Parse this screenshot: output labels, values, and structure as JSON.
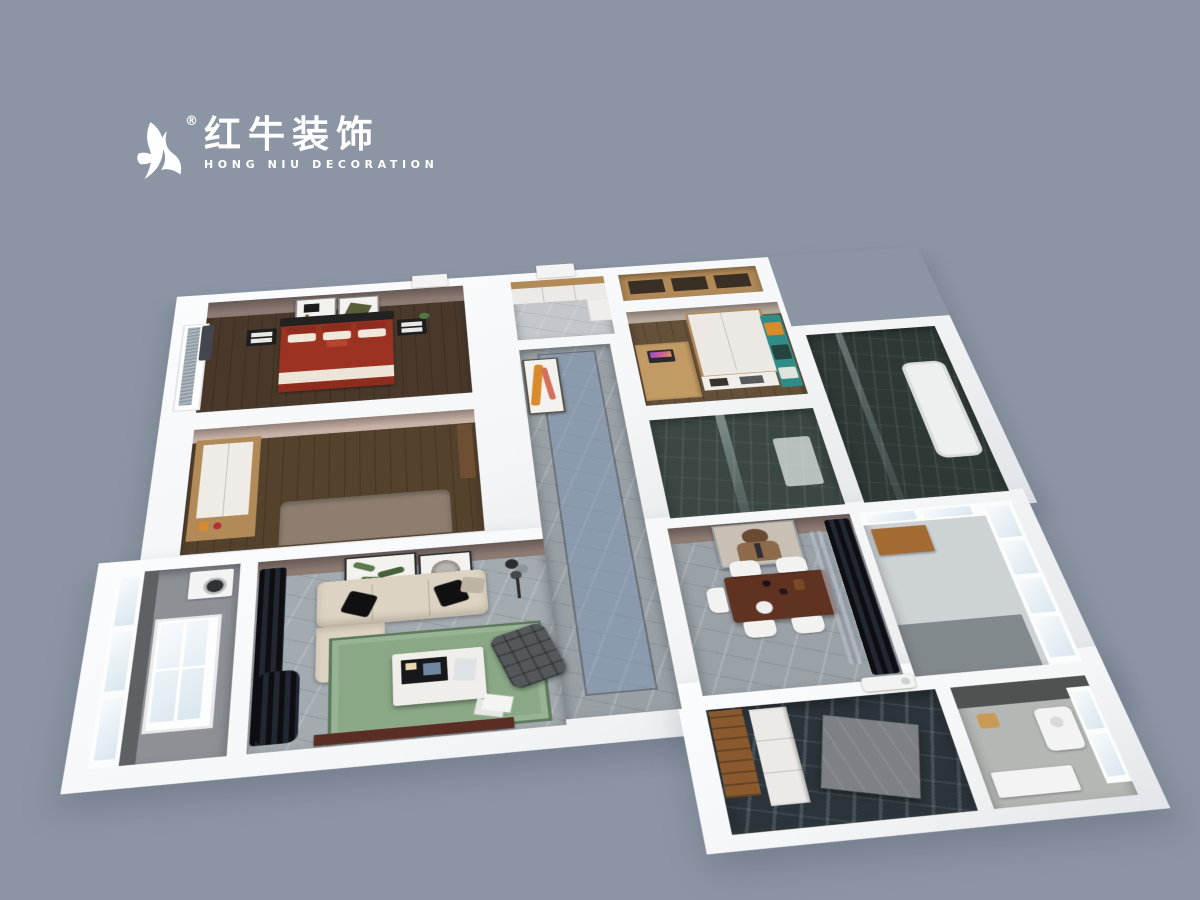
{
  "logo": {
    "brand_cn": "红牛装饰",
    "brand_en": "HONG NIU DECORATION",
    "registered_mark": "®",
    "icon": "bull-logo-icon",
    "color": "#ffffff"
  },
  "scene": {
    "type": "3d-floorplan-dollhouse-render",
    "description": "Bird's-eye 3D rendering of a furnished three-bedroom apartment with white cut walls on a slate blue-gray background",
    "rooms": [
      {
        "name": "master-bedroom",
        "floor": "dark wood",
        "items": [
          "double bed with red duvet",
          "black headboard",
          "two wall artworks",
          "black nightstands",
          "window with gray blinds"
        ]
      },
      {
        "name": "second-bedroom",
        "floor": "dark wood",
        "items": [
          "wood-framed white wardrobe",
          "bed",
          "shelf with amber bottles"
        ]
      },
      {
        "name": "entry-hall",
        "floor": "light marble",
        "items": [
          "white shoe cabinet with wood top",
          "open entry door"
        ]
      },
      {
        "name": "storage-closet",
        "items": [
          "wood shelving unit"
        ]
      },
      {
        "name": "study-bedroom",
        "floor": "wood",
        "items": [
          "desk with laptop",
          "white wardrobe with wood trim",
          "bed with teal and orange bedding"
        ]
      },
      {
        "name": "corridor",
        "floor": "gray marble",
        "items": [
          "blue highlighted walkway",
          "orange abstract wall art"
        ]
      },
      {
        "name": "shower-bathroom",
        "floor": "dark tile",
        "items": [
          "glass partition",
          "shower tray"
        ]
      },
      {
        "name": "tub-bathroom",
        "floor": "dark tile",
        "items": [
          "white bathtub"
        ]
      },
      {
        "name": "living-room",
        "floor": "gray marble",
        "items": [
          "beige L-shaped sofa",
          "black throw pillows",
          "green rug",
          "white marble coffee table",
          "floor lamp",
          "leaf artwork",
          "round artwork",
          "gray lounge chair",
          "black curtains",
          "TV console"
        ]
      },
      {
        "name": "dining-room",
        "floor": "gray marble",
        "items": [
          "dark wood dining table",
          "white chairs",
          "bear-in-suit painting",
          "black curtains"
        ]
      },
      {
        "name": "left-balcony",
        "items": [
          "floor-to-ceiling windows",
          "washing machine"
        ]
      },
      {
        "name": "right-balcony",
        "items": [
          "window grid",
          "wood cabinet"
        ]
      },
      {
        "name": "kitchen",
        "floor": "dark marble tile",
        "items": [
          "white cabinets",
          "wood door panel",
          "concrete counter",
          "AC unit"
        ]
      },
      {
        "name": "utility-balcony",
        "items": [
          "water heater",
          "window",
          "basket",
          "washbasin"
        ]
      }
    ]
  },
  "palette": {
    "bg": "#8b95a3",
    "wall": "#f5f6f7",
    "wallShade": "#e2e5e9",
    "wallFaceMauve": "#8d7a73",
    "wallFacePink": "#c8b1a6",
    "woodFloorDark": "#4a392b",
    "woodFloorMid": "#655039",
    "woodCab": "#b28a58",
    "marbleGray": "#a3aab0",
    "marbleLight": "#c3c7cb",
    "corridorMarble": "#98a0a6",
    "runnerBlue": "#7d93b8",
    "tileDark": "#3b4743",
    "tileDarker": "#2e3835",
    "kitchenTile": "#2b343a",
    "rug": "#8aa886",
    "rugBorder": "#5d7a5e",
    "sofa": "#ddd3c2",
    "bedRed": "#9c3322",
    "bedRedDark": "#8e2d1e",
    "headboard": "#222222",
    "curtainDark": "#101319",
    "glass": "#e8f0f4",
    "tableWood": "#5f3222",
    "tvWood": "#5a2e22",
    "accentOrange": "#d98a2b",
    "chairWhite": "#f2f2f0",
    "loungeGray": "#54585b",
    "balconyTile": "#8d9196",
    "utilFloor": "#b4b8b4",
    "woodDoor": "#8a5a2e",
    "concrete": "#7d8185",
    "artGreen": "#5c7a4a",
    "bearBrown": "#6b4a32",
    "tealBed": "#2f8c86"
  }
}
